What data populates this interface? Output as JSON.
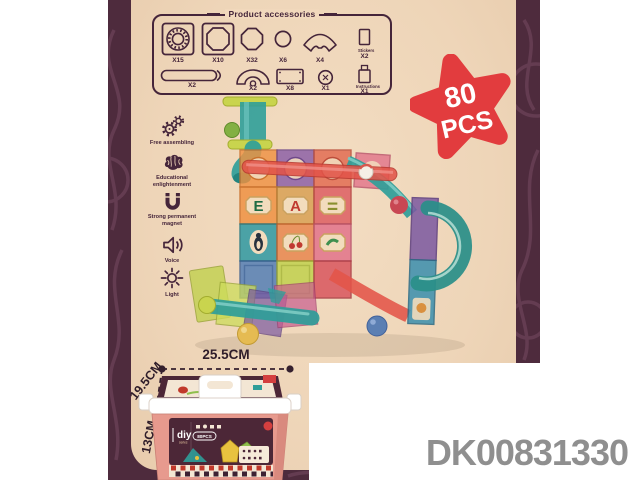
{
  "colors": {
    "frame": "#4e2b3d",
    "background": "#eed5b8",
    "star_red": "#e23c3e",
    "code_gray": "#8f8f8f",
    "box_pink": "#e79a8e",
    "label_dark": "#4c2737"
  },
  "accessories": {
    "title": "Product accessories",
    "items": [
      {
        "name": "bearing-square-tile",
        "qty": "X15"
      },
      {
        "name": "octagon-square-tile",
        "qty": "X10"
      },
      {
        "name": "octagon-piece",
        "qty": "X32"
      },
      {
        "name": "ball-piece",
        "qty": "X6"
      },
      {
        "name": "fan-piece",
        "qty": "X4"
      },
      {
        "name": "stickers",
        "label": "Stickers",
        "qty": "X2"
      },
      {
        "name": "long-tube",
        "qty": "X2"
      },
      {
        "name": "arch-piece",
        "qty": "X2"
      },
      {
        "name": "rectangle-tile",
        "qty": "X8"
      },
      {
        "name": "connector-piece",
        "qty": "X1"
      },
      {
        "name": "instructions",
        "label": "Instructions",
        "qty": "X1"
      }
    ]
  },
  "badge": {
    "value": "80",
    "unit": "PCS"
  },
  "features": [
    {
      "icon": "gears-icon",
      "label": "Free assembling"
    },
    {
      "icon": "brain-icon",
      "label": "Educational enlightenment"
    },
    {
      "icon": "magnet-icon",
      "label": "Strong permanent magnet"
    },
    {
      "icon": "speaker-icon",
      "label": "Voice"
    },
    {
      "icon": "light-icon",
      "label": "Light"
    }
  ],
  "photo": {
    "letters": [
      "E",
      "A",
      "="
    ]
  },
  "dimensions": {
    "width": "25.5CM",
    "depth": "19.5CM",
    "height": "13CM"
  },
  "box": {
    "brand": "Magnetic",
    "diy": "diy",
    "series": "series",
    "pcs": "80PCS"
  },
  "product_code": "DK00831330"
}
